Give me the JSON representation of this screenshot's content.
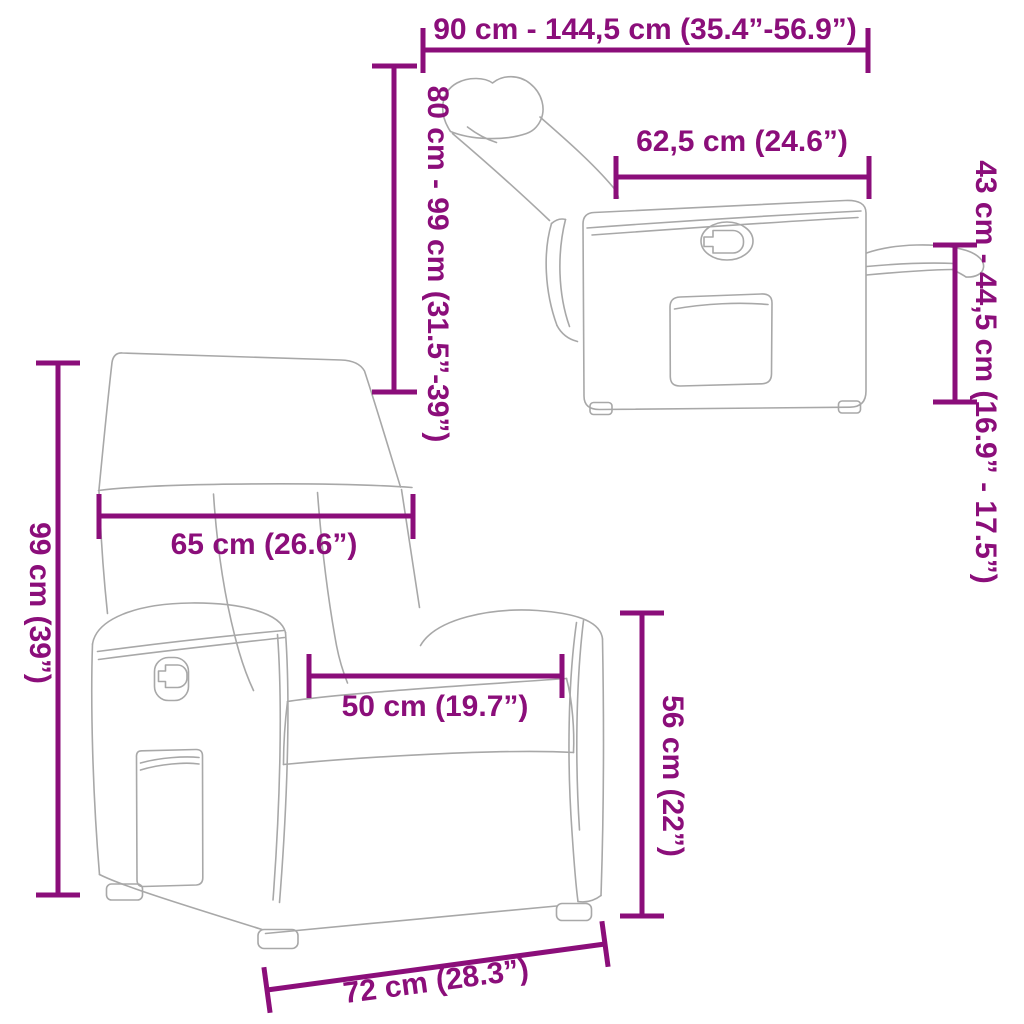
{
  "colors": {
    "accent": "#8B0E7A",
    "line": "#A8A8A8",
    "background": "#FFFFFF"
  },
  "labels": {
    "total_width": "90 cm - 144,5 cm (35.4”-56.9”)",
    "reclined_height": "80 cm - 99 cm (31.5”-39”)",
    "seat_depth": "62,5 cm (24.6”)",
    "footrest_height": "43 cm - 44,5 cm (16.9” - 17.5”)",
    "back_width": "65 cm (26.6”)",
    "total_height": "99 cm (39”)",
    "seat_width": "50 cm (19.7”)",
    "seat_height": "56 cm (22”)",
    "base_width": "72 cm (28.3”)"
  }
}
